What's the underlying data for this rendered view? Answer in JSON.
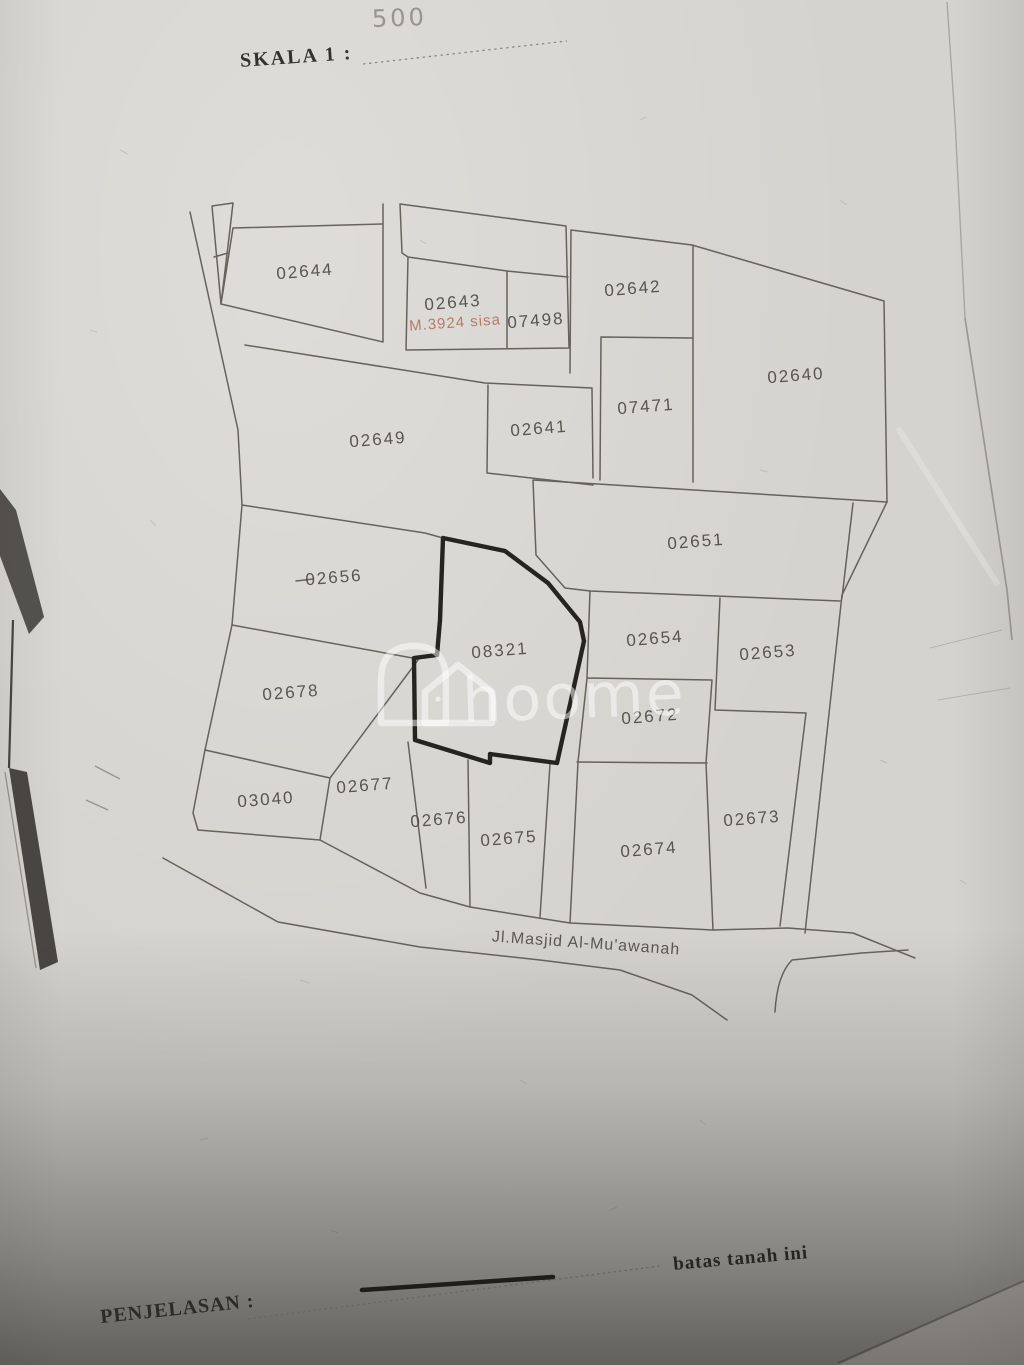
{
  "header": {
    "scale_label": "SKALA 1 :",
    "scale_value": "500"
  },
  "map": {
    "parcels": [
      {
        "label": "02644",
        "x": 305,
        "y": 272
      },
      {
        "label": "02643",
        "x": 453,
        "y": 303
      },
      {
        "label": "07498",
        "x": 536,
        "y": 321
      },
      {
        "label": "02642",
        "x": 633,
        "y": 289
      },
      {
        "label": "02640",
        "x": 796,
        "y": 376
      },
      {
        "label": "02649",
        "x": 378,
        "y": 440
      },
      {
        "label": "02641",
        "x": 539,
        "y": 429
      },
      {
        "label": "07471",
        "x": 646,
        "y": 407
      },
      {
        "label": "02651",
        "x": 696,
        "y": 542
      },
      {
        "label": "02656",
        "x": 334,
        "y": 578
      },
      {
        "label": "08321",
        "x": 500,
        "y": 651
      },
      {
        "label": "02654",
        "x": 655,
        "y": 639
      },
      {
        "label": "02653",
        "x": 768,
        "y": 653
      },
      {
        "label": "02678",
        "x": 291,
        "y": 693
      },
      {
        "label": "02672",
        "x": 650,
        "y": 717
      },
      {
        "label": "03040",
        "x": 266,
        "y": 800
      },
      {
        "label": "02677",
        "x": 365,
        "y": 786
      },
      {
        "label": "02676",
        "x": 439,
        "y": 820
      },
      {
        "label": "02675",
        "x": 509,
        "y": 839
      },
      {
        "label": "02674",
        "x": 649,
        "y": 850
      },
      {
        "label": "02673",
        "x": 752,
        "y": 819
      }
    ],
    "highlight_parcel": "08321",
    "red_annotation": "M.3924  sisa",
    "road_label": "Jl.Masjid  Al-Mu'awanah"
  },
  "watermark": {
    "text": "hoome"
  },
  "footer": {
    "label": "PENJELASAN :",
    "legend_text": "batas tanah ini"
  },
  "colors": {
    "ink": "#56534c",
    "bold_ink": "#26241f",
    "red": "#b5705f",
    "paper": "#d5d3ce"
  }
}
